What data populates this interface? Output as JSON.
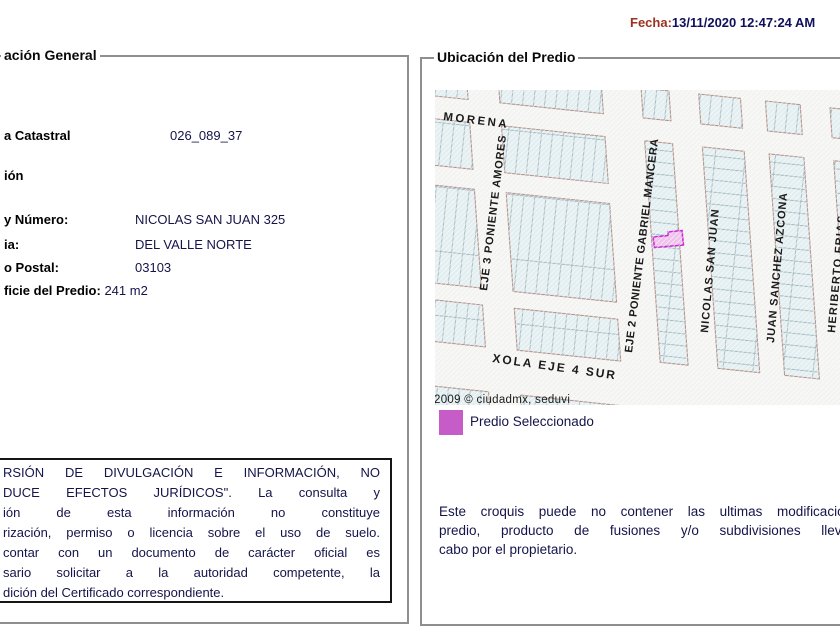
{
  "header": {
    "date_label": "Fecha:",
    "date_value": "13/11/2020 12:47:24 AM"
  },
  "general": {
    "legend": "ación General",
    "fields": {
      "cuenta_label": "a Catastral",
      "cuenta_value": "026_089_37",
      "direccion_label": "ión",
      "calle_label": "y Número:",
      "calle_value": "NICOLAS SAN JUAN 325",
      "colonia_label": "ia:",
      "colonia_value": "DEL VALLE NORTE",
      "cp_label": "o Postal:",
      "cp_value": "03103",
      "superficie_label": "ficie del Predio:",
      "superficie_value": "241 m2"
    },
    "disclaimer_lines": [
      "RSIÓN DE DIVULGACIÓN E INFORMACIÓN, NO",
      "DUCE EFECTOS JURÍDICOS\". La consulta y",
      "ión de esta información no constituye",
      "rización, permiso o licencia sobre el uso de suelo.",
      "contar con un documento de carácter oficial es",
      "sario solicitar a la autoridad competente, la",
      "dición del Certificado correspondiente."
    ]
  },
  "ubicacion": {
    "legend": "Ubicación del Predio",
    "map": {
      "attribution": "2009 © ciudadmx, seduvi",
      "street_labels": [
        {
          "name": "MORENA",
          "x": 8,
          "y": 30,
          "rotate": 7,
          "fs": 11.5,
          "ls": 2.5
        },
        {
          "name": "EJE 3 PONIENTE AMORES",
          "x": 52,
          "y": 201,
          "rotate": -83,
          "fs": 11,
          "ls": 0.8
        },
        {
          "name": "EJE 2 PONIENTE GABRIEL MANCERA",
          "x": 197,
          "y": 263,
          "rotate": -83,
          "fs": 11,
          "ls": 0.5
        },
        {
          "name": "NICOLAS SAN JUAN",
          "x": 273,
          "y": 243,
          "rotate": -85,
          "fs": 11,
          "ls": 1
        },
        {
          "name": "JUAN SANCHEZ AZCONA",
          "x": 339,
          "y": 253,
          "rotate": -85,
          "fs": 11,
          "ls": 0.8
        },
        {
          "name": "HERIBERTO FRIAS",
          "x": 400,
          "y": 243,
          "rotate": -85,
          "fs": 11,
          "ls": 1.2
        },
        {
          "name": "XOLA EJE 4 SUR",
          "x": 57,
          "y": 272,
          "rotate": 8,
          "fs": 12,
          "ls": 2
        }
      ],
      "colors": {
        "map_bg": "#f3f4f1",
        "block_fill": "#e3eef0",
        "block_stroke": "#b5958e",
        "parcel_line": "#a6bcc3",
        "hatch": "#ffffff",
        "label_color": "#1b1b1b",
        "selected_fill": "#efc2ec",
        "selected_stroke": "#cb2ed2"
      }
    },
    "map_legend": {
      "label": "Predio Seleccionado",
      "swatch_color": "#c55cc8"
    },
    "note_lines": [
      "Este croquis puede no contener las ultimas modificaciones del",
      "predio, producto de fusiones y/o subdivisiones llevadas a",
      "cabo por el propietario."
    ]
  }
}
